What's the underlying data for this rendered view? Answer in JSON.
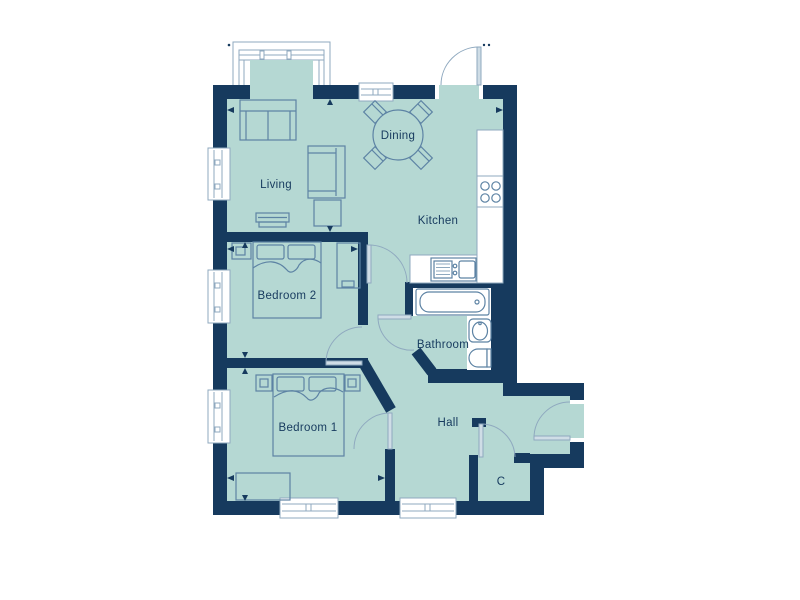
{
  "plan": {
    "rooms": [
      {
        "id": "living",
        "label": "Living"
      },
      {
        "id": "dining",
        "label": "Dining"
      },
      {
        "id": "kitchen",
        "label": "Kitchen"
      },
      {
        "id": "bedroom2",
        "label": "Bedroom 2"
      },
      {
        "id": "bedroom1",
        "label": "Bedroom 1"
      },
      {
        "id": "bathroom",
        "label": "Bathroom"
      },
      {
        "id": "hall",
        "label": "Hall"
      },
      {
        "id": "cupboard",
        "label": "C"
      }
    ],
    "fixtures": [
      "sofa",
      "armchair",
      "coffee-table",
      "tv-unit",
      "dining-table",
      "dining-chairs",
      "worktop",
      "hob",
      "sink-drainer",
      "bath",
      "basin",
      "toilet",
      "double-bed",
      "bedside-tables",
      "wardrobe",
      "chest-of-drawers"
    ],
    "colors": {
      "wall": "#163a5e",
      "floor": "#b5d8d3",
      "fixture_stroke": "#5d83a4",
      "frame_stroke": "#8fa9bf",
      "door_leaf": "#cfdde6",
      "label_text": "#163a5e",
      "background": "#ffffff"
    }
  }
}
